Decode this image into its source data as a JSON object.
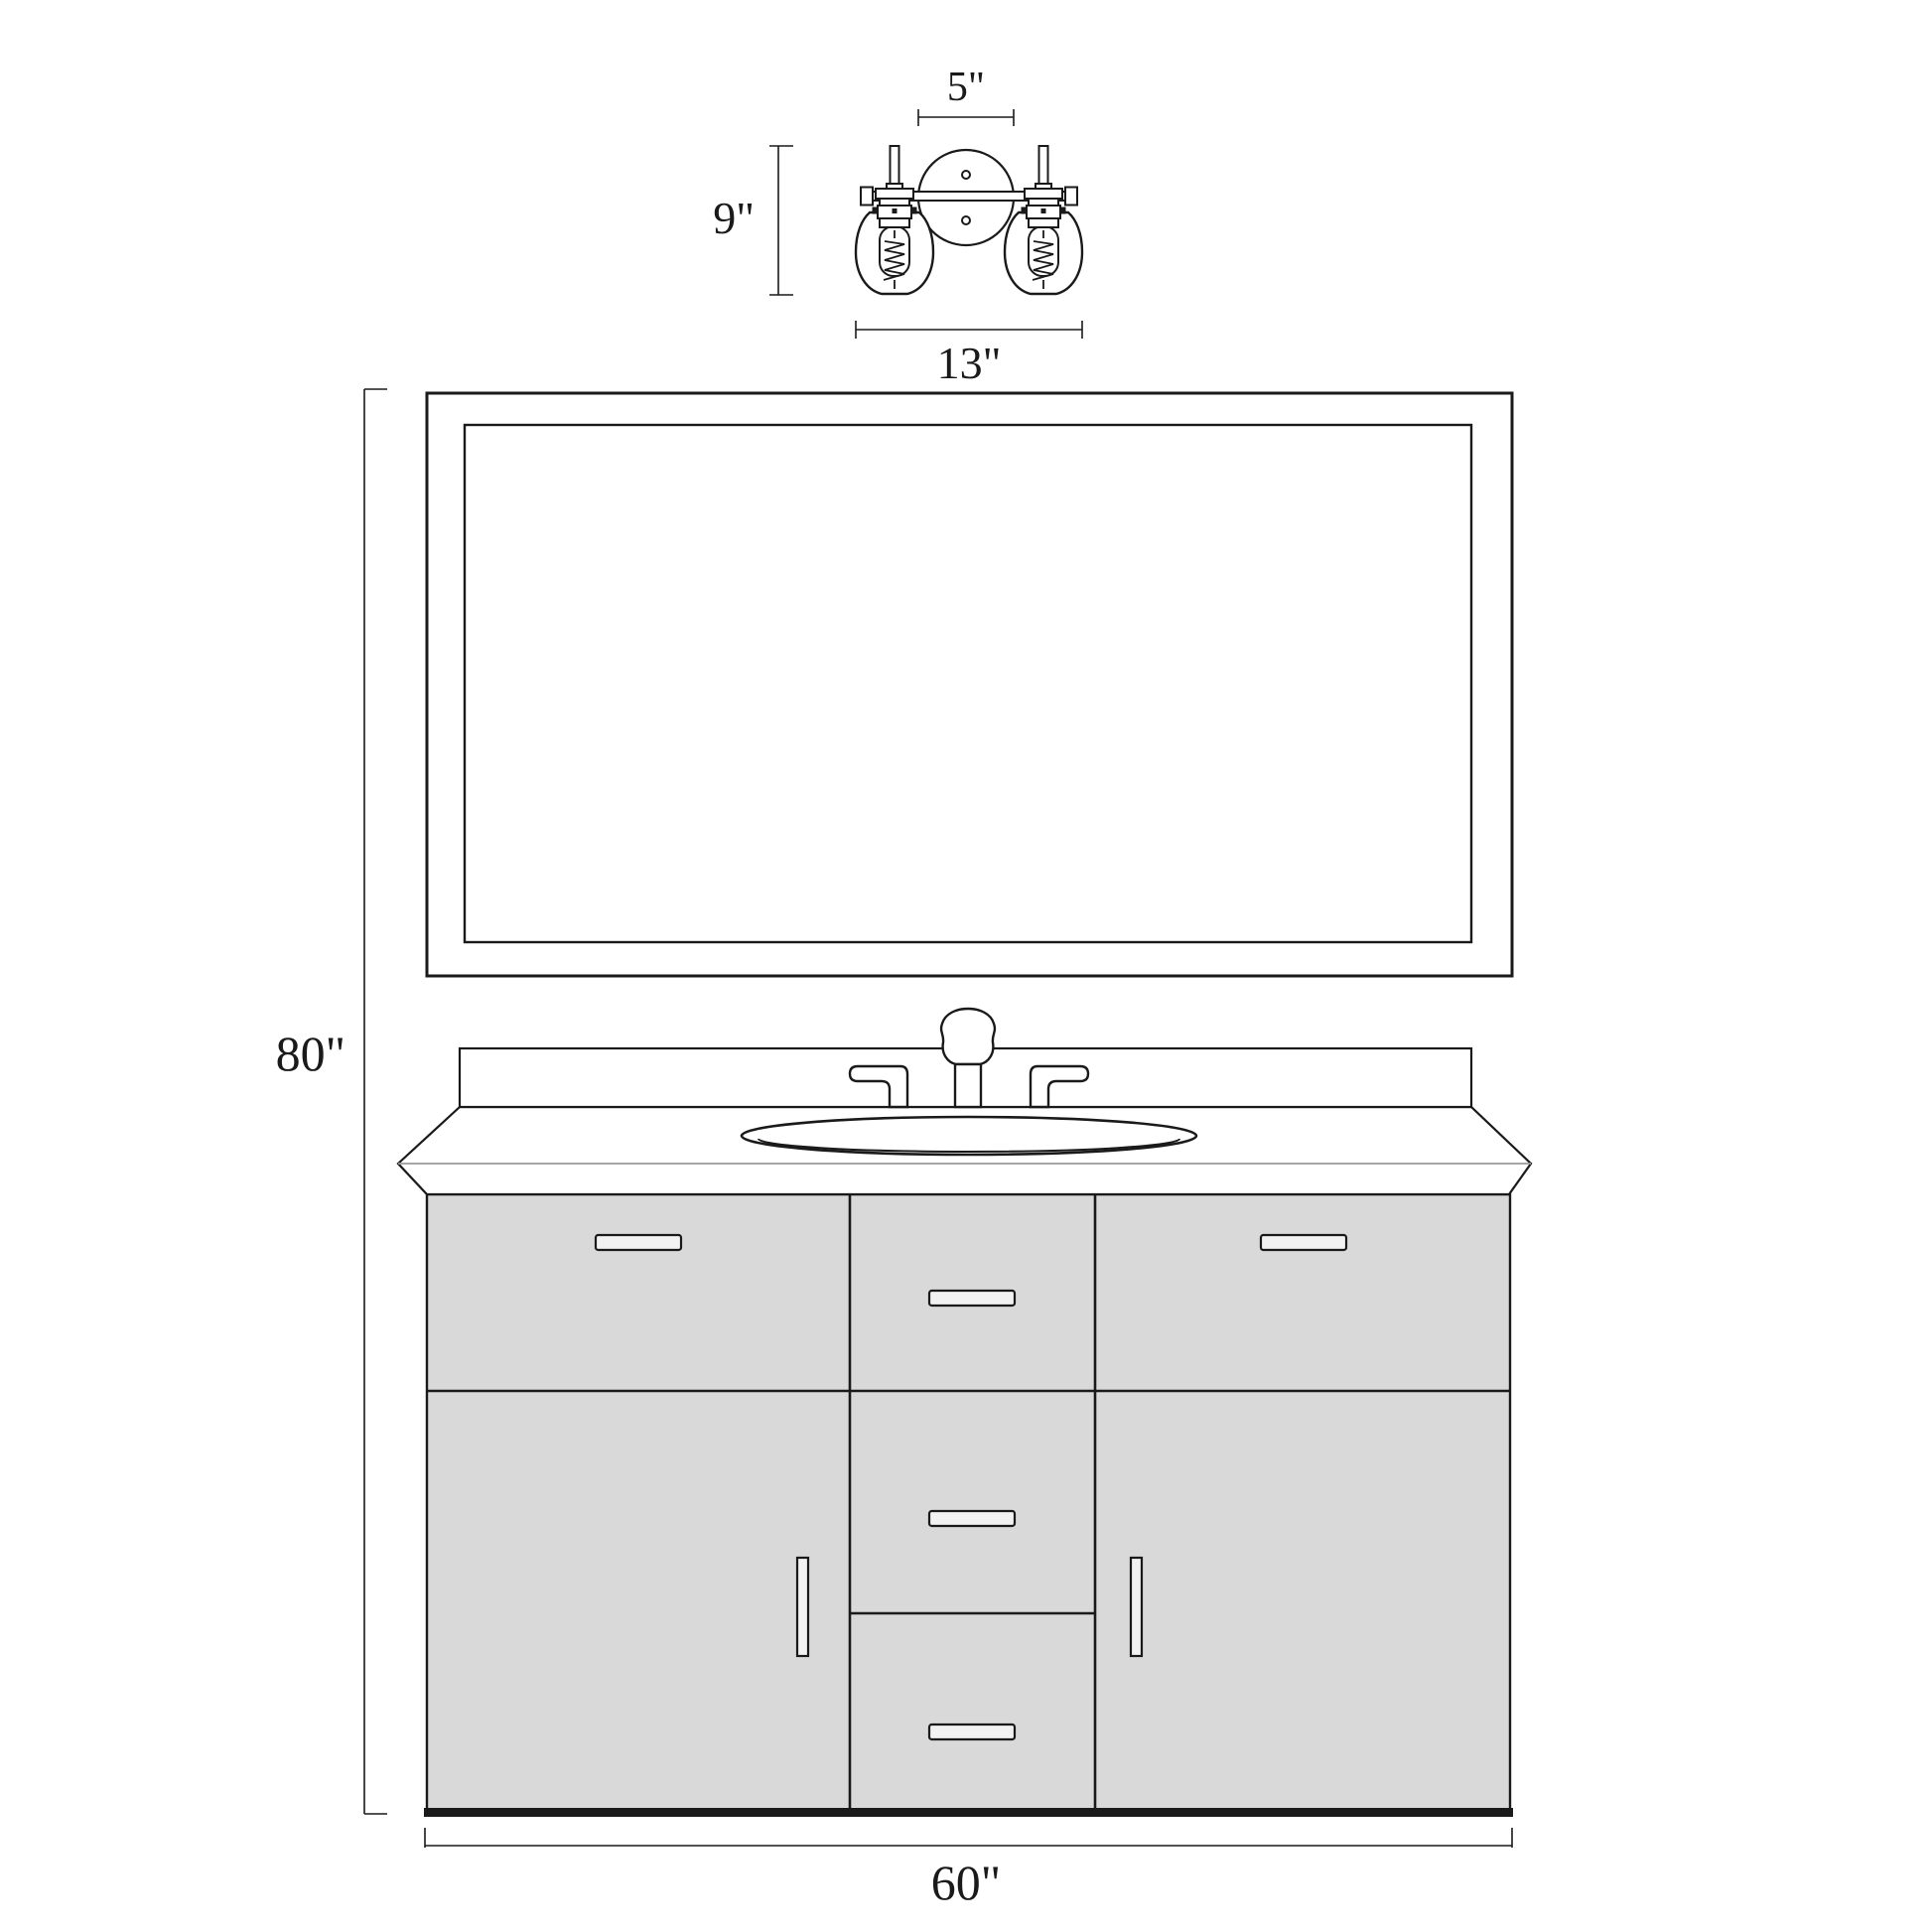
{
  "colors": {
    "line": "#1a1a1a",
    "background": "#ffffff",
    "cabinet_fill": "#d9d9d9",
    "handle_fill": "#f2f2f2",
    "counter_front_edge": "#9a9a9a"
  },
  "dimensions": {
    "fixture_backplate_width": {
      "label": "5\"",
      "value": 5,
      "unit": "in"
    },
    "fixture_height": {
      "label": "9\"",
      "value": 9,
      "unit": "in"
    },
    "fixture_width": {
      "label": "13\"",
      "value": 13,
      "unit": "in"
    },
    "overall_height": {
      "label": "80\"",
      "value": 80,
      "unit": "in"
    },
    "vanity_width": {
      "label": "60\"",
      "value": 60,
      "unit": "in"
    }
  }
}
